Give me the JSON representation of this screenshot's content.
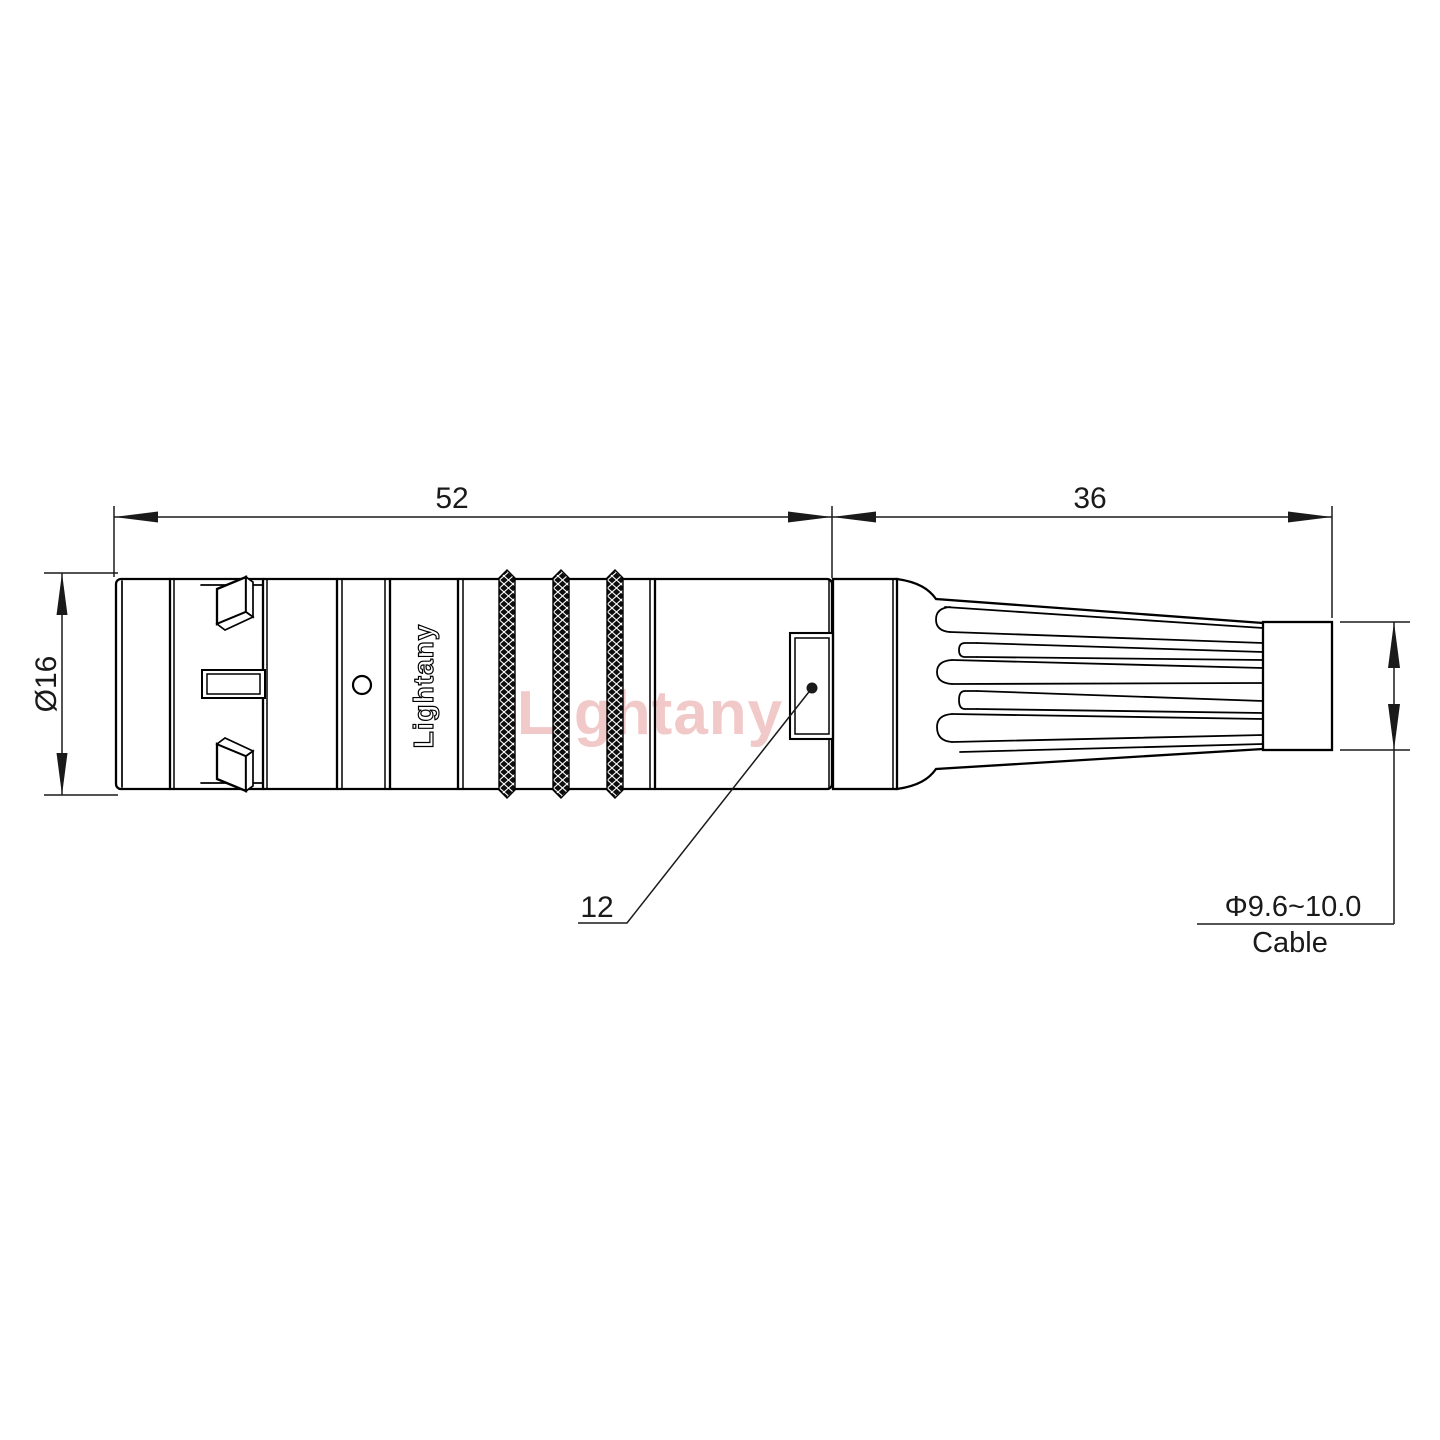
{
  "drawing": {
    "description": "Technical outline drawing of a circular push-pull cable connector, side view, with overall and cable dimensions",
    "watermark_text": "Lightany",
    "shell_logo_text": "Lightany",
    "dims": {
      "front_length": "52",
      "rear_length": "36",
      "shell_diameter": "Ø16",
      "flat_size": "12",
      "cable_range": "Φ9.6~10.0",
      "cable_word": "Cable"
    },
    "colors": {
      "line": "#000000",
      "background": "#ffffff",
      "watermark": "#f2c9c9"
    }
  }
}
